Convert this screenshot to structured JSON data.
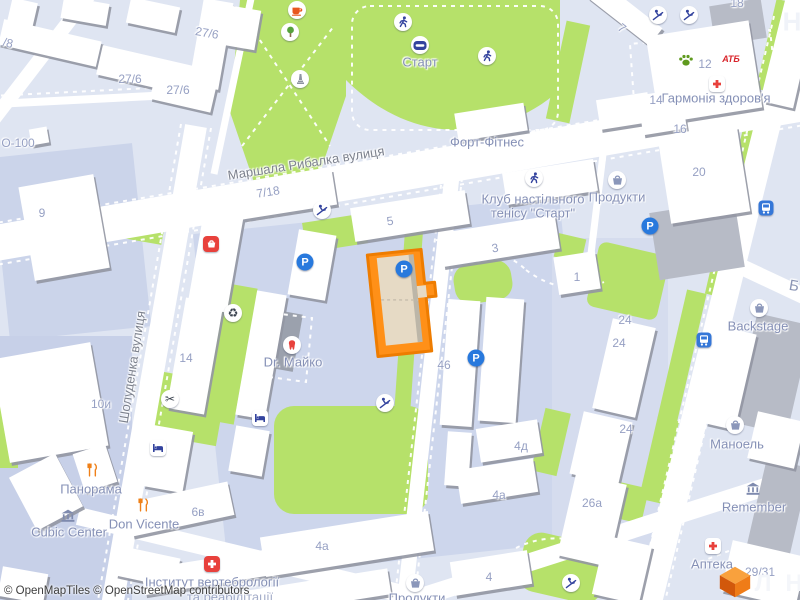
{
  "map": {
    "attribution": "© OpenMapTiles © OpenStreetMap contributors",
    "colors": {
      "background": "#dfe5f2",
      "city_block": "#cdd6ec",
      "green_area": "#b6e16a",
      "road": "#ffffff",
      "building": "#ffffff",
      "building_shadow": "#9296a2",
      "building_gray": "#b7bbc6",
      "highlight_fill": "#ff9018",
      "highlight_stroke": "#ee7c00",
      "highlight_inner": "#e6dac5",
      "street_label": "#7d828e",
      "poi_label": "#8590b6",
      "number_label": "#96a0c3",
      "icon_blue": "#2879dd",
      "icon_navy": "#33439e",
      "icon_red": "#e8413c",
      "icon_orange": "#ef8018",
      "icon_green": "#5f9a1e"
    }
  },
  "icon_glyphs": {
    "parking": "P",
    "recycling": "♻",
    "scissors": "✂",
    "atb": "АТБ"
  },
  "labels": [
    {
      "name": "street-marshala-rybalka",
      "cls": "street",
      "text": "Маршала Рибалка вулиця",
      "x": 306,
      "y": 163,
      "rot": -9
    },
    {
      "name": "street-sholudenka",
      "cls": "street",
      "text": "Шолуденка вулиця",
      "x": 132,
      "y": 367,
      "rot": -81
    },
    {
      "name": "poi-start-stadium",
      "cls": "poi",
      "text": "Старт",
      "x": 420,
      "y": 62,
      "rot": 0
    },
    {
      "name": "poi-fort-fitnes",
      "cls": "poi",
      "text": "Форт-Фітнес",
      "x": 487,
      "y": 142,
      "rot": 0
    },
    {
      "name": "poi-tennis-club-line1",
      "cls": "poi",
      "text": "Клуб настільного",
      "x": 533,
      "y": 199,
      "rot": 0
    },
    {
      "name": "poi-tennis-club-line2",
      "cls": "poi",
      "text": "тенісу \"Старт\"",
      "x": 533,
      "y": 213,
      "rot": 0
    },
    {
      "name": "poi-produkty-right",
      "cls": "poi",
      "text": "Продукти",
      "x": 617,
      "y": 197,
      "rot": 0
    },
    {
      "name": "poi-harmonia-zdorovya",
      "cls": "poi",
      "text": "Гармонія здоров'я",
      "x": 716,
      "y": 98,
      "rot": 0
    },
    {
      "name": "poi-dr-maiko",
      "cls": "poi",
      "text": "Dr. Майко",
      "x": 293,
      "y": 362,
      "rot": 0
    },
    {
      "name": "poi-panorama",
      "cls": "poi",
      "text": "Панорама",
      "x": 91,
      "y": 489,
      "rot": 0
    },
    {
      "name": "poi-cubic-center",
      "cls": "poi",
      "text": "Cubic Center",
      "x": 69,
      "y": 532,
      "rot": 0
    },
    {
      "name": "poi-don-vicente",
      "cls": "poi",
      "text": "Don Vicente",
      "x": 144,
      "y": 524,
      "rot": 0
    },
    {
      "name": "poi-instytut-vertebrologii",
      "cls": "poi",
      "text": "Інститут вертебрології",
      "x": 212,
      "y": 582,
      "rot": 0
    },
    {
      "name": "poi-ta-reabilitacii",
      "cls": "poi faint",
      "text": "та реабілітації",
      "x": 230,
      "y": 597,
      "rot": 0
    },
    {
      "name": "poi-produkty-bottom",
      "cls": "poi",
      "text": "Продукти",
      "x": 417,
      "y": 598,
      "rot": 0
    },
    {
      "name": "poi-backstage",
      "cls": "poi",
      "text": "Backstage",
      "x": 758,
      "y": 326,
      "rot": 0
    },
    {
      "name": "poi-manoel",
      "cls": "poi",
      "text": "Маноель",
      "x": 737,
      "y": 444,
      "rot": 0
    },
    {
      "name": "poi-remember",
      "cls": "poi",
      "text": "Remember",
      "x": 754,
      "y": 507,
      "rot": 0
    },
    {
      "name": "poi-apteka",
      "cls": "poi",
      "text": "Аптека",
      "x": 712,
      "y": 564,
      "rot": 0
    },
    {
      "name": "housenumber",
      "cls": "num",
      "text": "/8",
      "x": 8,
      "y": 43,
      "rot": 13
    },
    {
      "name": "housenumber",
      "cls": "num",
      "text": "27/6",
      "x": 207,
      "y": 33,
      "rot": 10
    },
    {
      "name": "housenumber",
      "cls": "num",
      "text": "27/6",
      "x": 130,
      "y": 79,
      "rot": 0
    },
    {
      "name": "housenumber",
      "cls": "num",
      "text": "27/6",
      "x": 178,
      "y": 90,
      "rot": 0
    },
    {
      "name": "housenumber",
      "cls": "num",
      "text": "О-100",
      "x": 18,
      "y": 143,
      "rot": 0
    },
    {
      "name": "housenumber",
      "cls": "num",
      "text": "9",
      "x": 42,
      "y": 213,
      "rot": 0
    },
    {
      "name": "housenumber",
      "cls": "num",
      "text": "7/18",
      "x": 268,
      "y": 192,
      "rot": -9
    },
    {
      "name": "housenumber",
      "cls": "num",
      "text": "5",
      "x": 390,
      "y": 221,
      "rot": -9
    },
    {
      "name": "housenumber",
      "cls": "num",
      "text": "3",
      "x": 495,
      "y": 248,
      "rot": -9
    },
    {
      "name": "housenumber",
      "cls": "num",
      "text": "1",
      "x": 577,
      "y": 277,
      "rot": 0
    },
    {
      "name": "housenumber",
      "cls": "num",
      "text": "7",
      "x": 622,
      "y": 28,
      "rot": 38
    },
    {
      "name": "housenumber",
      "cls": "num",
      "text": "12",
      "x": 705,
      "y": 64,
      "rot": 0
    },
    {
      "name": "housenumber",
      "cls": "num",
      "text": "14",
      "x": 656,
      "y": 100,
      "rot": 0
    },
    {
      "name": "housenumber",
      "cls": "num",
      "text": "16",
      "x": 680,
      "y": 129,
      "rot": 0
    },
    {
      "name": "housenumber",
      "cls": "num",
      "text": "18",
      "x": 737,
      "y": 3,
      "rot": 0
    },
    {
      "name": "housenumber",
      "cls": "num",
      "text": "20",
      "x": 699,
      "y": 172,
      "rot": 0
    },
    {
      "name": "housenumber",
      "cls": "num",
      "text": "14",
      "x": 186,
      "y": 358,
      "rot": 0
    },
    {
      "name": "housenumber",
      "cls": "num",
      "text": "10и",
      "x": 101,
      "y": 404,
      "rot": 0
    },
    {
      "name": "housenumber",
      "cls": "num",
      "text": "46",
      "x": 444,
      "y": 365,
      "rot": 0
    },
    {
      "name": "housenumber",
      "cls": "num",
      "text": "4д",
      "x": 521,
      "y": 446,
      "rot": 0
    },
    {
      "name": "housenumber",
      "cls": "num",
      "text": "4а",
      "x": 499,
      "y": 495,
      "rot": 0
    },
    {
      "name": "housenumber",
      "cls": "num",
      "text": "4а",
      "x": 322,
      "y": 546,
      "rot": 0
    },
    {
      "name": "housenumber",
      "cls": "num",
      "text": "4",
      "x": 489,
      "y": 577,
      "rot": 0
    },
    {
      "name": "housenumber",
      "cls": "num",
      "text": "6в",
      "x": 198,
      "y": 512,
      "rot": 0
    },
    {
      "name": "housenumber",
      "cls": "num",
      "text": "24",
      "x": 625,
      "y": 320,
      "rot": 0
    },
    {
      "name": "housenumber",
      "cls": "num",
      "text": "24",
      "x": 619,
      "y": 343,
      "rot": 0
    },
    {
      "name": "housenumber",
      "cls": "num",
      "text": "24",
      "x": 626,
      "y": 429,
      "rot": 0
    },
    {
      "name": "housenumber",
      "cls": "num",
      "text": "26а",
      "x": 592,
      "y": 503,
      "rot": 0
    },
    {
      "name": "housenumber",
      "cls": "num",
      "text": "29/31",
      "x": 760,
      "y": 572,
      "rot": 0
    },
    {
      "name": "partial-letter",
      "cls": "big-ghost",
      "text": "Н",
      "x": 792,
      "y": 22,
      "rot": 0
    },
    {
      "name": "partial-letter",
      "cls": "partial-blue",
      "text": "Б",
      "x": 794,
      "y": 286,
      "rot": 10
    },
    {
      "name": "partial-letter",
      "cls": "big-white",
      "text": "Л",
      "x": 763,
      "y": 584,
      "rot": 0
    },
    {
      "name": "partial-letter",
      "cls": "big-white",
      "text": "Н",
      "x": 794,
      "y": 584,
      "rot": 0
    }
  ],
  "icons": [
    {
      "name": "cafe-icon",
      "kind": "cafe",
      "x": 297,
      "y": 10
    },
    {
      "name": "tree-icon",
      "kind": "tree",
      "x": 290,
      "y": 32
    },
    {
      "name": "monument-icon",
      "kind": "monument",
      "x": 300,
      "y": 79
    },
    {
      "name": "runner-icon",
      "kind": "runner",
      "x": 403,
      "y": 22
    },
    {
      "name": "stadium-icon",
      "kind": "stadium",
      "x": 420,
      "y": 45
    },
    {
      "name": "runner-icon",
      "kind": "runner",
      "x": 487,
      "y": 56
    },
    {
      "name": "playground-icon",
      "kind": "playground",
      "x": 658,
      "y": 15
    },
    {
      "name": "playground-icon",
      "kind": "playground",
      "x": 689,
      "y": 15
    },
    {
      "name": "paw-icon",
      "kind": "paw",
      "x": 686,
      "y": 60
    },
    {
      "name": "atb-logo",
      "kind": "atb",
      "x": 731,
      "y": 59
    },
    {
      "name": "pharmacy-cross-icon",
      "kind": "cross-red",
      "x": 717,
      "y": 84
    },
    {
      "name": "shop-icon",
      "kind": "shop-red",
      "x": 211,
      "y": 244
    },
    {
      "name": "parking-icon",
      "kind": "parking",
      "x": 305,
      "y": 262
    },
    {
      "name": "parking-icon",
      "kind": "parking",
      "x": 404,
      "y": 269
    },
    {
      "name": "recycling-icon",
      "kind": "recycling",
      "x": 233,
      "y": 313
    },
    {
      "name": "dentist-tooth-icon",
      "kind": "tooth",
      "x": 292,
      "y": 345
    },
    {
      "name": "playground-icon",
      "kind": "playground",
      "x": 322,
      "y": 210
    },
    {
      "name": "hairdresser-scissors-icon",
      "kind": "scissors",
      "x": 170,
      "y": 399
    },
    {
      "name": "parking-icon",
      "kind": "parking",
      "x": 476,
      "y": 358
    },
    {
      "name": "playground-icon",
      "kind": "playground",
      "x": 385,
      "y": 403
    },
    {
      "name": "hotel-bed-icon",
      "kind": "bed",
      "x": 260,
      "y": 418
    },
    {
      "name": "hotel-bed-icon",
      "kind": "bed",
      "x": 158,
      "y": 448
    },
    {
      "name": "restaurant-icon",
      "kind": "restaurant",
      "x": 92,
      "y": 470
    },
    {
      "name": "bank-building-icon",
      "kind": "museum",
      "x": 68,
      "y": 516
    },
    {
      "name": "restaurant-icon",
      "kind": "restaurant",
      "x": 143,
      "y": 505
    },
    {
      "name": "clinic-cross-icon",
      "kind": "cross-white",
      "x": 212,
      "y": 564
    },
    {
      "name": "grocery-basket-icon",
      "kind": "basket",
      "x": 415,
      "y": 583
    },
    {
      "name": "playground-icon",
      "kind": "playground",
      "x": 571,
      "y": 583
    },
    {
      "name": "parking-icon",
      "kind": "parking",
      "x": 650,
      "y": 226
    },
    {
      "name": "grocery-basket-icon",
      "kind": "basket",
      "x": 617,
      "y": 180
    },
    {
      "name": "table-tennis-club-icon",
      "kind": "runner",
      "x": 534,
      "y": 178
    },
    {
      "name": "bus-stop-icon",
      "kind": "bus",
      "x": 766,
      "y": 208
    },
    {
      "name": "bus-stop-icon",
      "kind": "bus",
      "x": 704,
      "y": 340
    },
    {
      "name": "shop-basket-icon",
      "kind": "basket",
      "x": 759,
      "y": 308
    },
    {
      "name": "shop-basket-icon",
      "kind": "basket",
      "x": 735,
      "y": 425
    },
    {
      "name": "museum-building-icon",
      "kind": "museum",
      "x": 753,
      "y": 489
    },
    {
      "name": "pharmacy-cross-icon",
      "kind": "cross-red",
      "x": 713,
      "y": 546
    }
  ]
}
